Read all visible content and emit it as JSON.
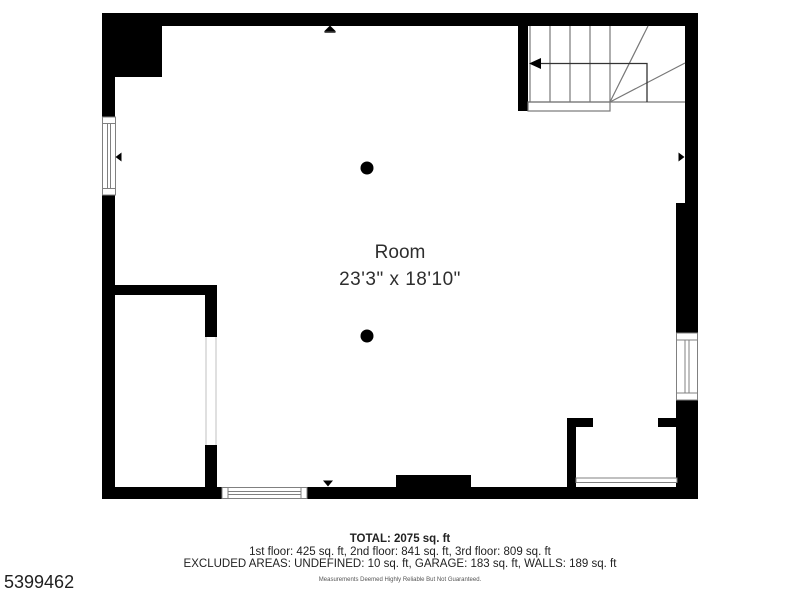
{
  "floorplan": {
    "room": {
      "name": "Room",
      "dimensions": "23'3\" x 18'10\""
    },
    "summary": {
      "total": "TOTAL: 2075 sq. ft",
      "floors": "1st floor: 425 sq. ft, 2nd floor: 841 sq. ft, 3rd floor: 809 sq. ft",
      "excluded": "EXCLUDED AREAS: UNDEFINED: 10 sq. ft, GARAGE: 183 sq. ft, WALLS: 189 sq. ft",
      "disclaimer": "Measurements Deemed Highly Reliable But Not Guaranteed."
    },
    "listing_number": "5399462",
    "colors": {
      "wall": "#000000",
      "stair_line": "#777777",
      "walkline": "#333333",
      "window_line": "#808080",
      "text": "#2e2e2e"
    }
  }
}
